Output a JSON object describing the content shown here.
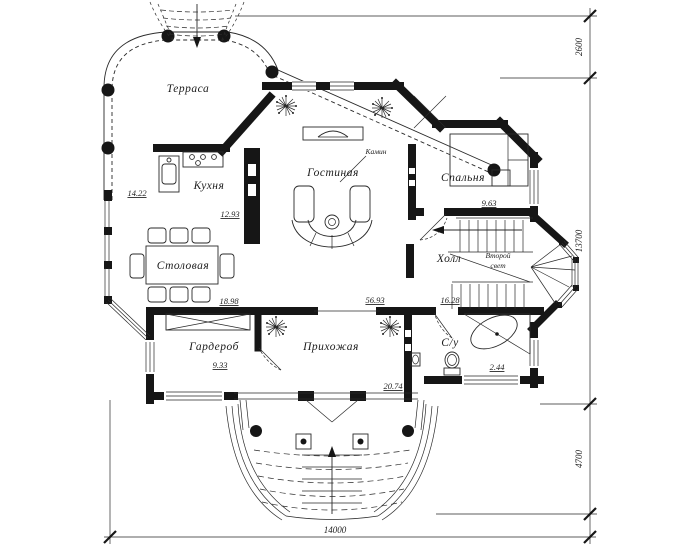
{
  "drawing": {
    "kind": "architectural floor plan, first floor",
    "language": "ru",
    "ink_color": "#1c1c1c",
    "paper_color": "#ffffff"
  },
  "rooms": [
    {
      "id": "terrace",
      "label": "Терраса"
    },
    {
      "id": "kitchen",
      "label": "Кухня"
    },
    {
      "id": "living-room",
      "label": "Гостиная"
    },
    {
      "id": "bedroom",
      "label": "Спальня"
    },
    {
      "id": "dining-room",
      "label": "Столовая"
    },
    {
      "id": "hall",
      "label": "Холл"
    },
    {
      "id": "wardrobe",
      "label": "Гардероб"
    },
    {
      "id": "entrance-hall",
      "label": "Прихожая"
    },
    {
      "id": "bathroom",
      "label": "С/у"
    }
  ],
  "annotations": {
    "fireplace": "Камин",
    "second_light_line1": "Второй",
    "second_light_line2": "свет"
  },
  "areas": [
    {
      "value": "14.22"
    },
    {
      "value": "12.93"
    },
    {
      "value": "18.98"
    },
    {
      "value": "56.93"
    },
    {
      "value": "16.28"
    },
    {
      "value": "9.63"
    },
    {
      "value": "9.33"
    },
    {
      "value": "20.74"
    },
    {
      "value": "2.44"
    }
  ],
  "dimensions": {
    "right_top": "2600",
    "right_middle": "13700",
    "right_bottom": "4700",
    "bottom": "14000"
  }
}
